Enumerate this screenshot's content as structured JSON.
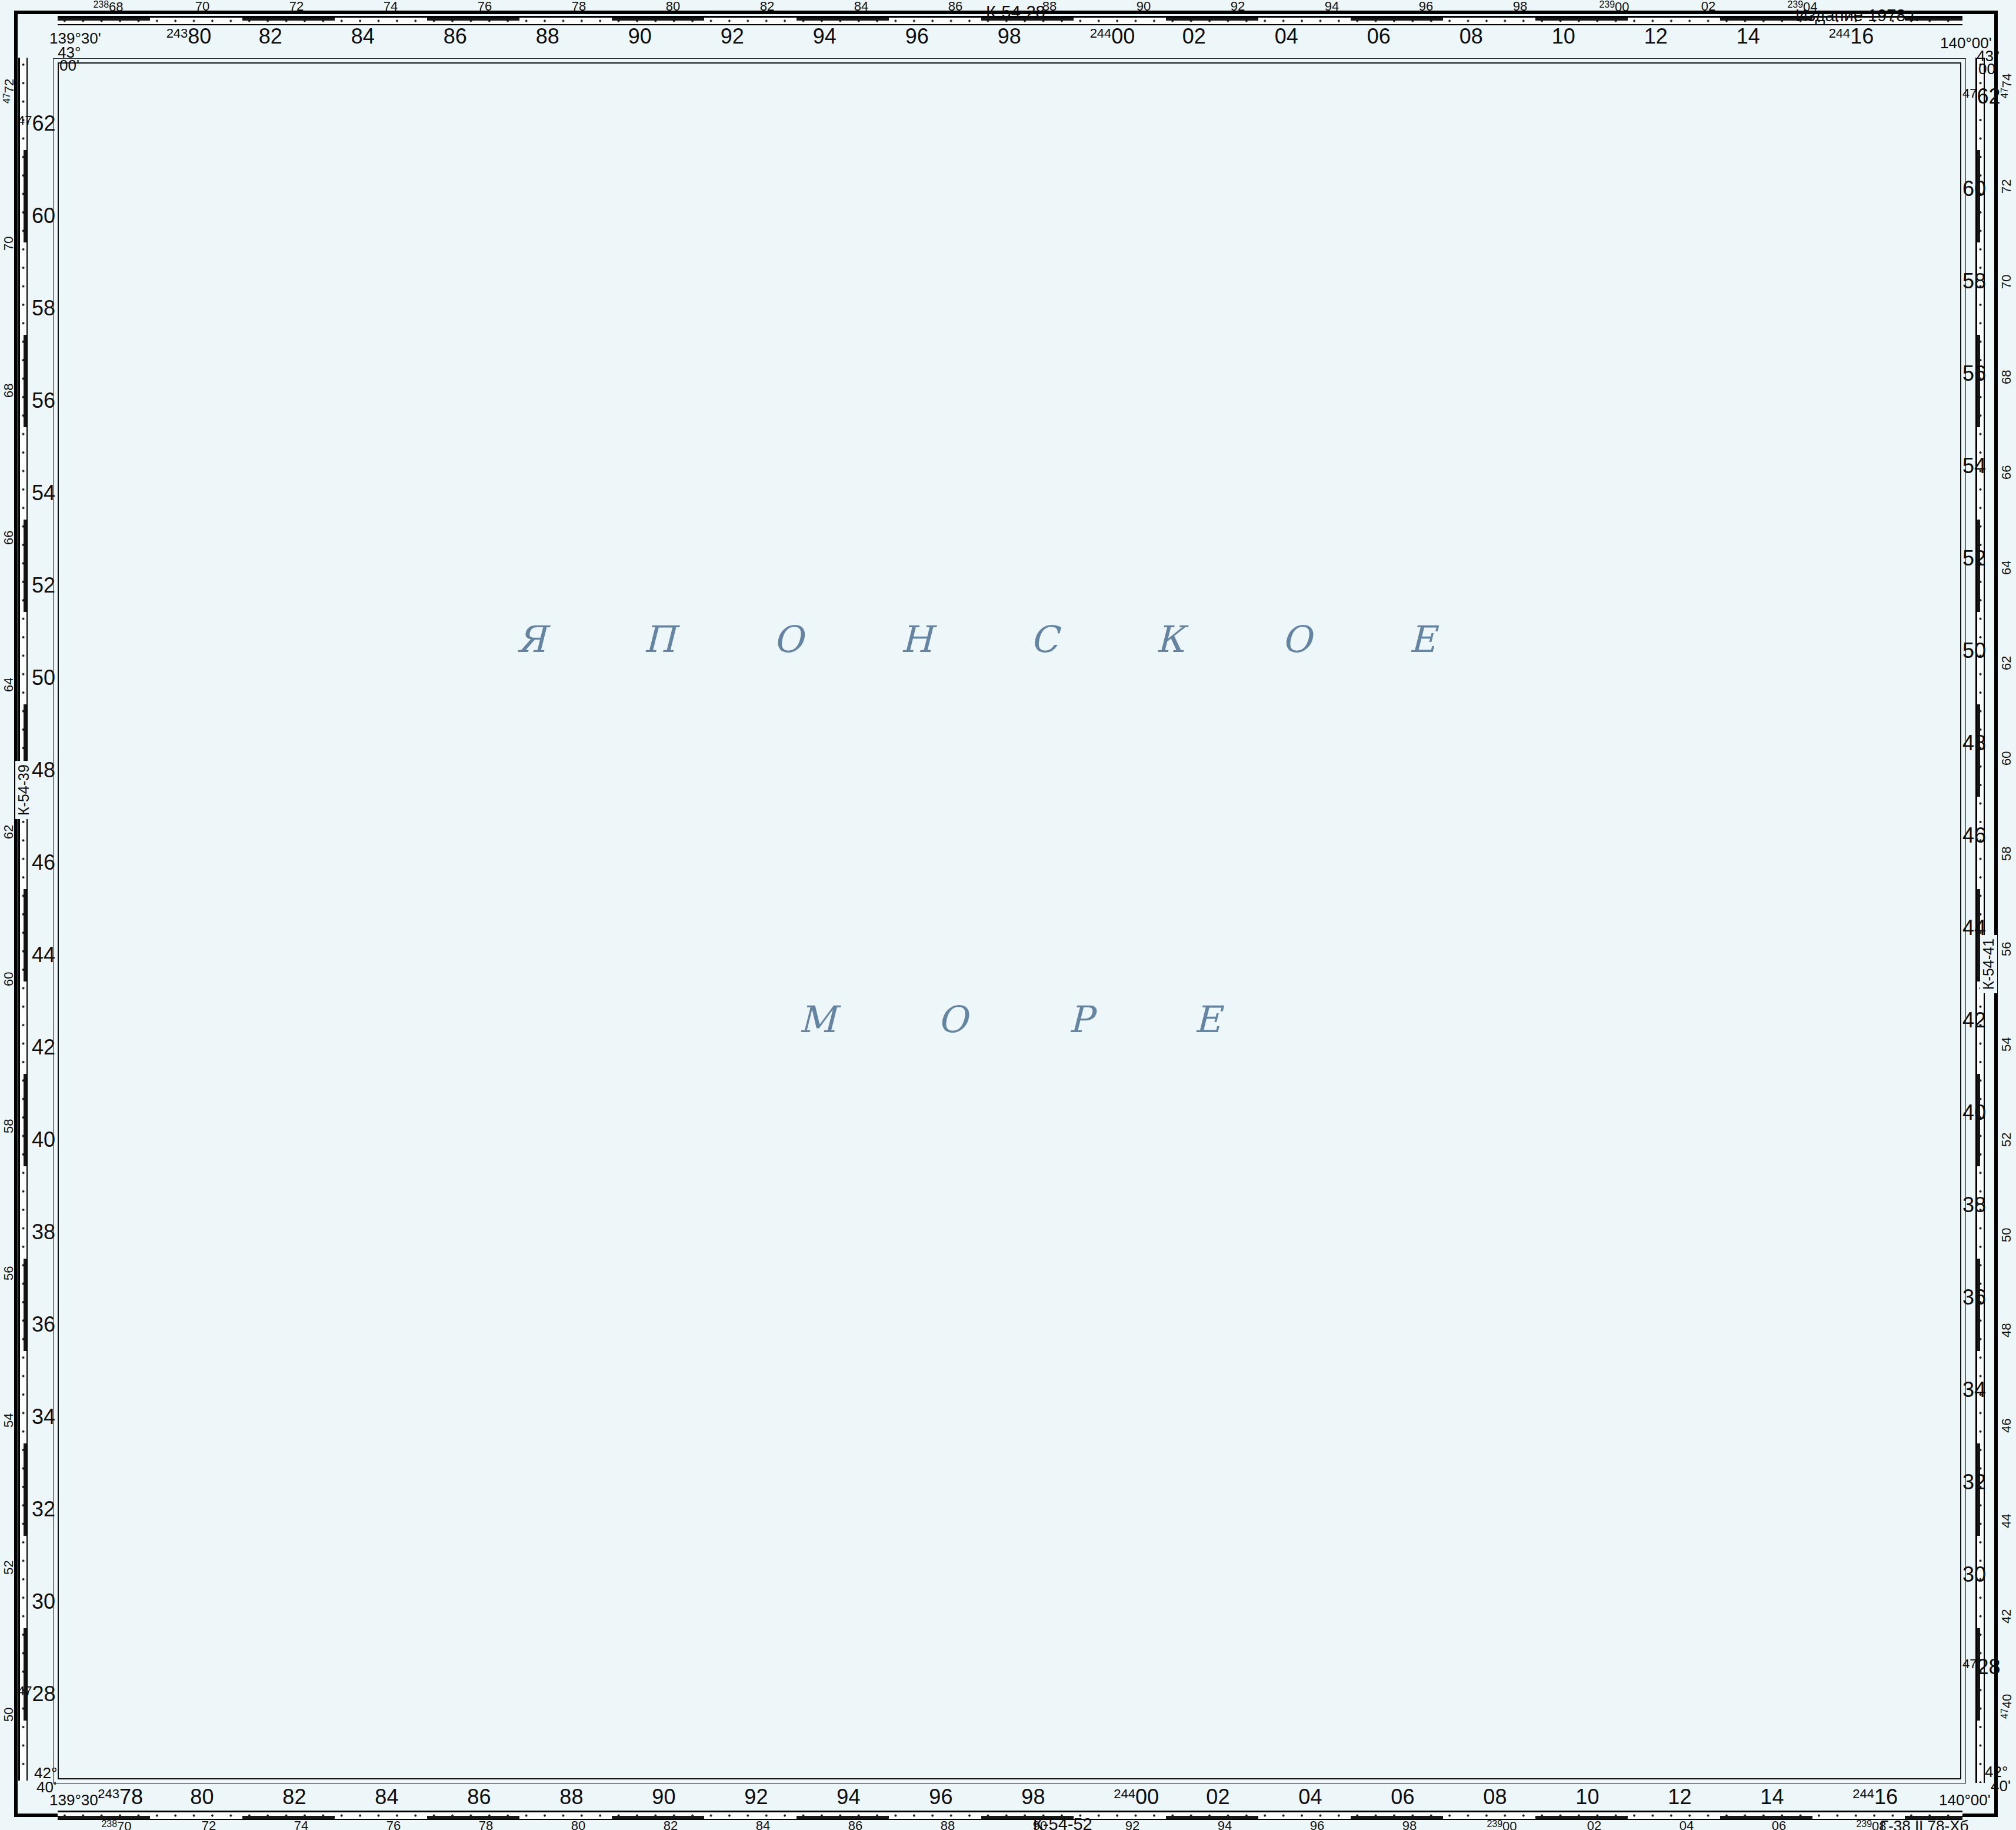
{
  "sheet": {
    "edition": "\u0418\u0437\u0434\u0430\u043d\u0438\u0435 1978 \u0433.",
    "neighbor_top": "\u041a-54-28",
    "neighbor_left": "\u041a-54-39",
    "neighbor_right": "\u041a-54-41",
    "neighbor_bottom": "\u041a-54-52",
    "print_code": "\u0413-38 II 78-\u0425\u0431"
  },
  "corners": {
    "tl": {
      "lon": "139\u00b030'",
      "lat_deg": "43\u00b0",
      "lat_min": "00'"
    },
    "tr": {
      "lon": "140\u00b000'",
      "lat_deg": "43\u00b0",
      "lat_min": "00'"
    },
    "bl": {
      "lat_deg": "42\u00b0",
      "lat_min": "40'",
      "lon": "139\u00b030'"
    },
    "br": {
      "lat_deg": "42\u00b0",
      "lat_min": "40'",
      "lon": "140\u00b000'"
    }
  },
  "sea": {
    "name_top": "\u042f\u041f\u041e\u041d\u0421\u041a\u041e\u0415",
    "name_bottom": "\u041c\u041e\u0420\u0415"
  },
  "grid": {
    "columns": [
      {
        "v": "78",
        "pb": "243",
        "top": false
      },
      {
        "v": "80",
        "pt": "243"
      },
      {
        "v": "82"
      },
      {
        "v": "84"
      },
      {
        "v": "86"
      },
      {
        "v": "88"
      },
      {
        "v": "90"
      },
      {
        "v": "92"
      },
      {
        "v": "94"
      },
      {
        "v": "96"
      },
      {
        "v": "98"
      },
      {
        "v": "00",
        "pt": "244",
        "pb": "244"
      },
      {
        "v": "02"
      },
      {
        "v": "04"
      },
      {
        "v": "06"
      },
      {
        "v": "08"
      },
      {
        "v": "10"
      },
      {
        "v": "12"
      },
      {
        "v": "14"
      },
      {
        "v": "16",
        "pt": "244",
        "pb": "244"
      }
    ],
    "rows": [
      {
        "v": "62",
        "p": "47"
      },
      {
        "v": "60"
      },
      {
        "v": "58"
      },
      {
        "v": "56"
      },
      {
        "v": "54"
      },
      {
        "v": "52"
      },
      {
        "v": "50"
      },
      {
        "v": "48"
      },
      {
        "v": "46"
      },
      {
        "v": "44"
      },
      {
        "v": "42"
      },
      {
        "v": "40"
      },
      {
        "v": "38"
      },
      {
        "v": "36"
      },
      {
        "v": "34"
      },
      {
        "v": "32"
      },
      {
        "v": "30"
      },
      {
        "v": "28",
        "p": "47"
      }
    ]
  },
  "scales": {
    "top": {
      "values": [
        {
          "v": "68",
          "p": "238"
        },
        {
          "v": "70"
        },
        {
          "v": "72"
        },
        {
          "v": "74"
        },
        {
          "v": "76"
        },
        {
          "v": "78"
        },
        {
          "v": "80"
        },
        {
          "v": "82"
        },
        {
          "v": "84"
        },
        {
          "v": "86"
        },
        {
          "v": "88"
        },
        {
          "v": "90"
        },
        {
          "v": "92"
        },
        {
          "v": "94"
        },
        {
          "v": "96"
        },
        {
          "v": "98"
        },
        {
          "v": "00",
          "p": "239"
        },
        {
          "v": "02"
        },
        {
          "v": "04",
          "p": "239"
        }
      ]
    },
    "bottom": {
      "values": [
        {
          "v": "70",
          "p": "238"
        },
        {
          "v": "72"
        },
        {
          "v": "74"
        },
        {
          "v": "76"
        },
        {
          "v": "78"
        },
        {
          "v": "80"
        },
        {
          "v": "82"
        },
        {
          "v": "84"
        },
        {
          "v": "86"
        },
        {
          "v": "88"
        },
        {
          "v": "90"
        },
        {
          "v": "92"
        },
        {
          "v": "94"
        },
        {
          "v": "96"
        },
        {
          "v": "98"
        },
        {
          "v": "00",
          "p": "239"
        },
        {
          "v": "02"
        },
        {
          "v": "04"
        },
        {
          "v": "06"
        },
        {
          "v": "08",
          "p": "239"
        }
      ]
    },
    "left": {
      "values": [
        {
          "v": "72",
          "p": "47"
        },
        {
          "v": "70"
        },
        {
          "v": "68"
        },
        {
          "v": "66"
        },
        {
          "v": "64"
        },
        {
          "v": "62"
        },
        {
          "v": "60"
        },
        {
          "v": "58"
        },
        {
          "v": "56"
        },
        {
          "v": "54"
        },
        {
          "v": "52"
        },
        {
          "v": "50"
        }
      ]
    },
    "right": {
      "values": [
        {
          "v": "74",
          "p": "47"
        },
        {
          "v": "72"
        },
        {
          "v": "70"
        },
        {
          "v": "68"
        },
        {
          "v": "66"
        },
        {
          "v": "64"
        },
        {
          "v": "62"
        },
        {
          "v": "60"
        },
        {
          "v": "58"
        },
        {
          "v": "56"
        },
        {
          "v": "54"
        },
        {
          "v": "52"
        },
        {
          "v": "50"
        },
        {
          "v": "48"
        },
        {
          "v": "46"
        },
        {
          "v": "44"
        },
        {
          "v": "42"
        },
        {
          "v": "40",
          "p": "47"
        }
      ]
    }
  },
  "intersections": [
    {
      "c": "86",
      "r": "58",
      "h": "4758",
      "v": "24386",
      "big": true
    },
    {
      "c": "98",
      "r": "58",
      "h": "58",
      "v": "98"
    },
    {
      "c": "10",
      "r": "58",
      "h": "58",
      "v": "10"
    },
    {
      "c": "98",
      "r": "46",
      "h": "46",
      "v": "98"
    },
    {
      "c": "86",
      "r": "44",
      "h": "44",
      "v": "86"
    },
    {
      "c": "10",
      "r": "44",
      "h": "44",
      "v": "10"
    },
    {
      "c": "86",
      "r": "34",
      "h": "34",
      "v": "86"
    },
    {
      "c": "98",
      "r": "34",
      "h": "34",
      "v": "98"
    },
    {
      "c": "10",
      "r": "34",
      "h": "34",
      "v": "10"
    }
  ],
  "latlon_cross": {
    "lat": "42\u00b050'",
    "lon": "139\u00b045'",
    "x": 1712,
    "y": 1562
  },
  "depths": [
    [
      2980,
      162,
      "1609"
    ],
    [
      2475,
      355,
      "2277"
    ],
    [
      1637,
      450,
      "2460"
    ],
    [
      2885,
      622,
      "1708"
    ],
    [
      1540,
      1035,
      "3393"
    ],
    [
      2760,
      1078,
      "1288"
    ],
    [
      3290,
      1222,
      "344"
    ],
    [
      2450,
      1337,
      "1755"
    ],
    [
      2790,
      1332,
      "1406"
    ],
    [
      1015,
      1565,
      "2476"
    ],
    [
      2722,
      1592,
      "1736"
    ],
    [
      2162,
      1832,
      "1435"
    ],
    [
      2323,
      1828,
      "1486"
    ],
    [
      1680,
      1858,
      "2578"
    ],
    [
      3175,
      1888,
      "499"
    ],
    [
      3255,
      1978,
      "764"
    ],
    [
      1998,
      2122,
      "1778"
    ],
    [
      2292,
      2168,
      "1653"
    ],
    [
      3250,
      2252,
      "894"
    ],
    [
      3186,
      2284,
      "310"
    ],
    [
      1332,
      2212,
      "2399"
    ],
    [
      1692,
      2398,
      "2079"
    ],
    [
      1134,
      2431,
      "3169"
    ],
    [
      2845,
      2552,
      "628"
    ],
    [
      3192,
      2548,
      "713"
    ],
    [
      1360,
      2662,
      "1586"
    ],
    [
      3135,
      2668,
      "192"
    ],
    [
      3065,
      2728,
      "155"
    ],
    [
      3000,
      2782,
      "58"
    ],
    [
      432,
      2882,
      "2269"
    ],
    [
      822,
      2902,
      "3350"
    ],
    [
      1642,
      2892,
      "2554"
    ],
    [
      2470,
      2938,
      "179"
    ],
    [
      1455,
      2988,
      "652"
    ]
  ],
  "contour_depths": [
    [
      2357,
      2926,
      "71"
    ],
    [
      2710,
      2826,
      "31"
    ],
    [
      2798,
      2820,
      "46"
    ],
    [
      2607,
      2916,
      "46"
    ],
    [
      2881,
      2788,
      "21"
    ],
    [
      3156,
      2766,
      "92"
    ],
    [
      3214,
      2786,
      "8"
    ]
  ],
  "coast": {
    "cape": "\u043c. \u041a\u0430\u043c\u0430\u043a\u0438-\u041c\u0438\u0441\u0430\u043a\u0438",
    "rock": "\u0441\u043a.\u0410\u043d\u0430\u043c\u0430-\u0418\u0432\u0430",
    "town1": "\u0425\u0430\u0440\u0430\u0443\u0442\u0430",
    "town2": "\u0414\u0430\u0439\u043d\u0438-\u0421\u0430\u043a\u0430\u0437\u0445\u0430\u043c\u0430",
    "school": "\u0448\u043a.",
    "tunnel": "\u0442\u0443\u043d.",
    "station_vert": "\u0422\u0438\u0432\u0430\u0441\u0435",
    "river_vert": "\u0424\u0443\u043d\u0430\u043a\u0430\u0439-\u041a\u0430\u0432\u0430",
    "river_margin": "\u041e\u0434\u0430\u043d\u0438\u0441\u0438-\u041a\u0430\u0432\u0430",
    "road_note": "\u0421\u0443\u043a\u043a\u0438 4 \u043a\u043c",
    "heights": [
      {
        "x": 2978,
        "y": 2898,
        "t": "575.4",
        "sym": "tri",
        "big": true
      },
      {
        "x": 3268,
        "y": 2858,
        "t": "180.8",
        "sym": "tri"
      },
      {
        "x": 3212,
        "y": 2912,
        "t": "235.0",
        "sym": "dot"
      },
      {
        "x": 2688,
        "y": 2940,
        "t": "223.0",
        "sym": "dot"
      }
    ],
    "boxed_height": {
      "x": 2884,
      "y": 2820,
      "t": "229"
    }
  }
}
